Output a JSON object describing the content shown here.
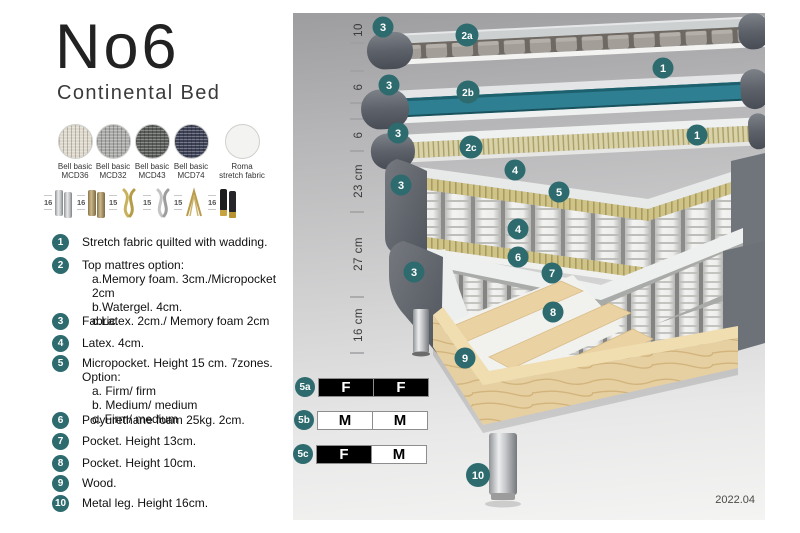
{
  "header": {
    "title": "No6",
    "subtitle": "Continental Bed"
  },
  "fabrics": [
    {
      "line1": "Bell basic",
      "line2": "MCD36",
      "color": "#ddd8cb"
    },
    {
      "line1": "Bell basic",
      "line2": "MCD32",
      "color": "#a9a9a7"
    },
    {
      "line1": "Bell basic",
      "line2": "MCD43",
      "color": "#5a5c5a"
    },
    {
      "line1": "Bell basic",
      "line2": "MCD74",
      "color": "#3c4156"
    },
    {
      "line1": "Roma",
      "line2": "stretch fabric",
      "color": "#f3f3f1"
    }
  ],
  "legs": [
    {
      "height": "16",
      "icon": "cylinder-chrome-leg-icon"
    },
    {
      "height": "16",
      "icon": "cylinder-bronze-leg-icon"
    },
    {
      "height": "15",
      "icon": "twist-gold-leg-icon"
    },
    {
      "height": "15",
      "icon": "twist-silver-leg-icon"
    },
    {
      "height": "15",
      "icon": "hairpin-gold-leg-icon"
    },
    {
      "height": "16",
      "icon": "cylinder-black-gold-leg-icon"
    }
  ],
  "features": [
    {
      "num": "1",
      "text": "Stretch fabric quilted with wadding."
    },
    {
      "num": "2",
      "text": "Top mattres option:",
      "sub": [
        "a.Memory foam. 3cm./Micropocket 2cm",
        "b.Watergel. 4cm.",
        "c.Latex. 2cm./ Memory foam 2cm"
      ]
    },
    {
      "num": "3",
      "text": "Fabric."
    },
    {
      "num": "4",
      "text": "Latex. 4cm."
    },
    {
      "num": "5",
      "text": "Micropocket. Height 15 cm. 7zones. Option:",
      "sub": [
        "a. Firm/ firm",
        "b. Medium/ medium",
        "c. Firm/ medium"
      ]
    },
    {
      "num": "6",
      "text": "Polyurethane foam 25kg. 2cm."
    },
    {
      "num": "7",
      "text": "Pocket. Height 13cm."
    },
    {
      "num": "8",
      "text": "Pocket. Height 10cm."
    },
    {
      "num": "9",
      "text": "Wood."
    },
    {
      "num": "10",
      "text": "Metal leg. Height 16cm."
    }
  ],
  "diagram": {
    "ruler": [
      "10",
      "6",
      "6",
      "23 cm",
      "27 cm",
      "16 cm"
    ],
    "badges": [
      {
        "label": "3"
      },
      {
        "label": "2a"
      },
      {
        "label": "1"
      },
      {
        "label": "3"
      },
      {
        "label": "2b"
      },
      {
        "label": "3"
      },
      {
        "label": "2c"
      },
      {
        "label": "1"
      },
      {
        "label": "4"
      },
      {
        "label": "5"
      },
      {
        "label": "3"
      },
      {
        "label": "4"
      },
      {
        "label": "6"
      },
      {
        "label": "3"
      },
      {
        "label": "7"
      },
      {
        "label": "8"
      },
      {
        "label": "9"
      },
      {
        "label": "10"
      }
    ],
    "firmness": [
      {
        "label": "5a",
        "cells": [
          {
            "text": "F",
            "bg": "#000000",
            "fg": "#ffffff"
          },
          {
            "text": "F",
            "bg": "#000000",
            "fg": "#ffffff"
          }
        ]
      },
      {
        "label": "5b",
        "cells": [
          {
            "text": "M",
            "bg": "#ffffff",
            "fg": "#000000"
          },
          {
            "text": "M",
            "bg": "#ffffff",
            "fg": "#000000"
          }
        ]
      },
      {
        "label": "5c",
        "cells": [
          {
            "text": "F",
            "bg": "#000000",
            "fg": "#ffffff"
          },
          {
            "text": "M",
            "bg": "#ffffff",
            "fg": "#000000"
          }
        ]
      }
    ],
    "version": "2022.04"
  },
  "colors": {
    "badge": "#2e6b6f",
    "watergel": "#2d7f91",
    "foam": "#cfc387",
    "wood": "#e6cfa0",
    "fabric": "#5f636b"
  }
}
